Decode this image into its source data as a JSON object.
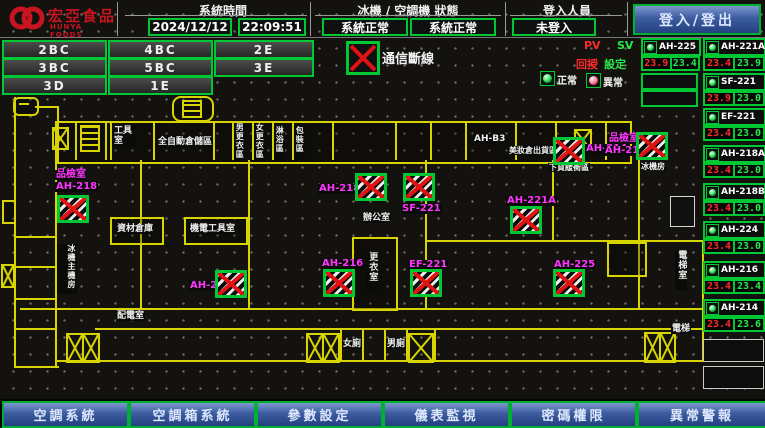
{
  "header": {
    "logo_title": "宏亞食品",
    "logo_subtitle": "HUNYA FOODS",
    "time_section": {
      "label": "系統時間",
      "date": "2024/12/12",
      "time": "22:09:51"
    },
    "status_section": {
      "label": "冰機 / 空調機 狀態",
      "chiller_status": "系統正常",
      "ahu_status": "系統正常"
    },
    "login_section": {
      "label": "登入人員",
      "status": "未登入"
    },
    "login_button": "登入/登出"
  },
  "nav": {
    "buttons": [
      "2BC",
      "4BC",
      "2E",
      "3BC",
      "5BC",
      "3E",
      "3D",
      "1E"
    ]
  },
  "legend": {
    "comm_fail": "通信斷線",
    "pv": "PV",
    "sv": "SV",
    "feedback": "回授",
    "setpoint": "設定",
    "normal": "正常",
    "abnormal": "異常"
  },
  "units": [
    {
      "name": "AH-225",
      "pv": "23.9",
      "sv": "23.4"
    },
    {
      "name": "AH-221A",
      "pv": "23.4",
      "sv": "23.9"
    },
    {
      "name": "SF-221",
      "pv": "23.9",
      "sv": "23.0"
    },
    {
      "name": "EF-221",
      "pv": "23.4",
      "sv": "23.0"
    },
    {
      "name": "AH-218A",
      "pv": "23.4",
      "sv": "23.0"
    },
    {
      "name": "AH-218B",
      "pv": "23.4",
      "sv": "23.0"
    },
    {
      "name": "AH-224",
      "pv": "23.4",
      "sv": "23.0"
    },
    {
      "name": "AH-216",
      "pv": "23.4",
      "sv": "23.4"
    },
    {
      "name": "AH-214",
      "pv": "23.4",
      "sv": "23.6"
    }
  ],
  "map": {
    "rooms": [
      "工具室",
      "全自動倉儲區",
      "男更衣區",
      "女更衣區",
      "淋浴區",
      "包裝區",
      "AH-B3",
      "美妝倉出貨區",
      "下貨緩衝區",
      "冰機房",
      "資材倉庫",
      "機電工具室",
      "冰機主機房",
      "辦公室",
      "更衣室",
      "配電室",
      "女廁",
      "男廁",
      "電梯室",
      "電梯"
    ],
    "equip_labels": [
      "品檢室",
      "AH-218",
      "AH-218A",
      "SF-221",
      "AH-221A",
      "AH-214",
      "品檢室",
      "AH-218B",
      "AH-224",
      "AH-216",
      "EF-221",
      "AH-225"
    ]
  },
  "footer": {
    "buttons": [
      "空調系統",
      "空調箱系統",
      "參數設定",
      "儀表監視",
      "密碼權限",
      "異常警報"
    ]
  },
  "colors": {
    "accent_green": "#00c832",
    "alarm_red": "#ff2a2a",
    "magenta": "#ff35ff",
    "wall_yellow": "#d8d400",
    "button_blue": "#3c5ca0"
  }
}
